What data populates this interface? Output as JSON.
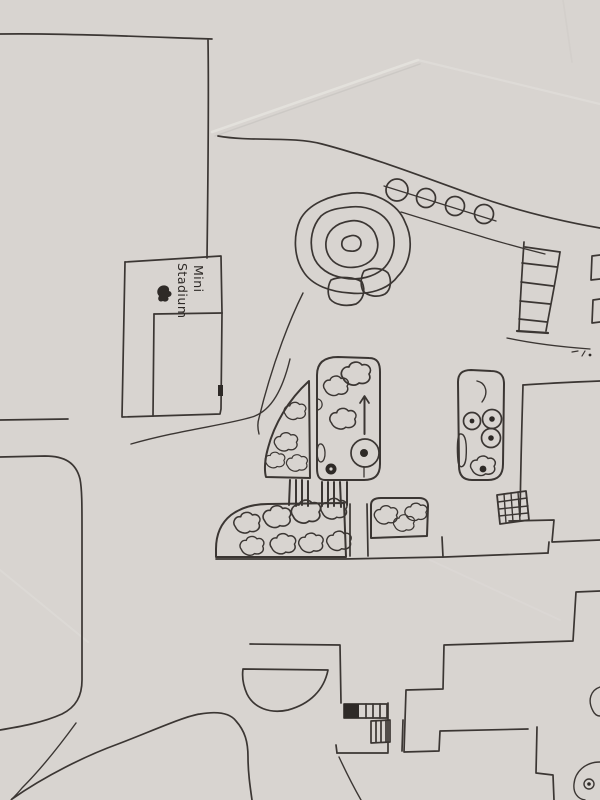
{
  "sketch": {
    "label_mini_stadium": {
      "line1": "Mini",
      "line2": "Stadium"
    },
    "colors": {
      "paper": "#d8d4d0",
      "paper_shade": "#c8c4c0",
      "crease_light": "#e6e3df",
      "ink": "#3b3633",
      "ink_dark": "#2e2a27"
    }
  }
}
